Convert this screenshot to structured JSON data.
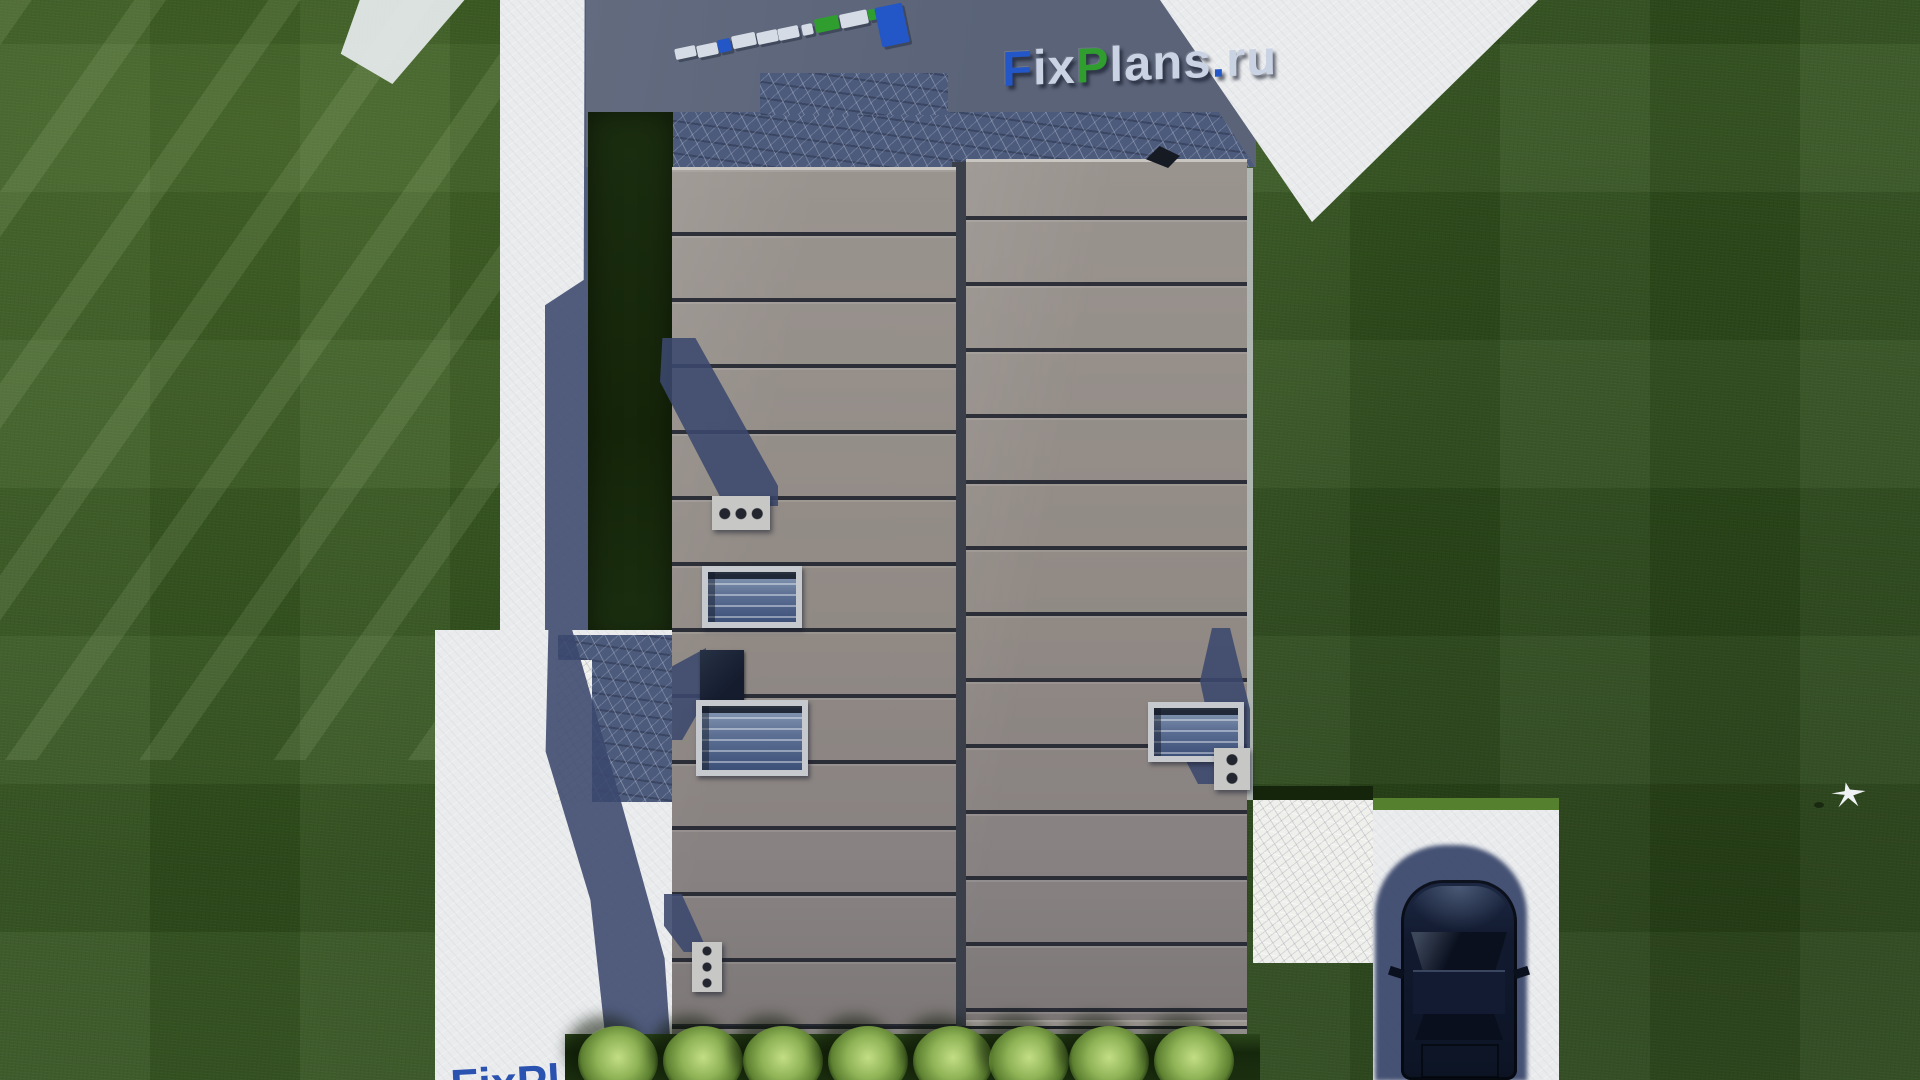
{
  "watermark": {
    "text": "FixPlans.ru",
    "letters": [
      {
        "ch": "F",
        "c": "blue"
      },
      {
        "ch": "i",
        "c": "light"
      },
      {
        "ch": "x",
        "c": "light"
      },
      {
        "ch": "P",
        "c": "green"
      },
      {
        "ch": "l",
        "c": "light"
      },
      {
        "ch": "a",
        "c": "light"
      },
      {
        "ch": "n",
        "c": "light"
      },
      {
        "ch": "s",
        "c": "light"
      },
      {
        "ch": ".",
        "c": "blue"
      },
      {
        "ch": "r",
        "c": "light"
      },
      {
        "ch": "u",
        "c": "light"
      }
    ]
  },
  "watermark_partial": {
    "text": "FixPl"
  },
  "ground_letters": {
    "description": "tops of 3D logo letters lying on the terrace, seen from above",
    "blocks": [
      {
        "x": 5,
        "y": 47,
        "w": 21,
        "h": 11,
        "c": "light"
      },
      {
        "x": 27,
        "y": 44,
        "w": 21,
        "h": 12,
        "c": "light"
      },
      {
        "x": 48,
        "y": 39,
        "w": 13,
        "h": 13,
        "c": "blue"
      },
      {
        "x": 62,
        "y": 34,
        "w": 24,
        "h": 13,
        "c": "light"
      },
      {
        "x": 87,
        "y": 31,
        "w": 21,
        "h": 12,
        "c": "light"
      },
      {
        "x": 108,
        "y": 27,
        "w": 21,
        "h": 12,
        "c": "light"
      },
      {
        "x": 132,
        "y": 24,
        "w": 11,
        "h": 11,
        "c": "light"
      },
      {
        "x": 145,
        "y": 17,
        "w": 24,
        "h": 14,
        "c": "green"
      },
      {
        "x": 170,
        "y": 12,
        "w": 28,
        "h": 14,
        "c": "light"
      },
      {
        "x": 198,
        "y": 9,
        "w": 10,
        "h": 11,
        "c": "green"
      },
      {
        "x": 208,
        "y": 5,
        "w": 28,
        "h": 40,
        "c": "blue"
      }
    ]
  },
  "bushes": {
    "count": 8,
    "centers_x": [
      618,
      703,
      783,
      868,
      953,
      1029,
      1109,
      1194
    ],
    "top_y": 1026
  },
  "palette": {
    "grass": "#30501c",
    "grass_dark_band": "#16280c",
    "hedge": "#16270d",
    "concrete_shadow": "#5a6378",
    "concrete_light": "#e9ebed",
    "stone_shadow": "#4c5a7c",
    "stone_light": "#efefec",
    "roof": "#918b88",
    "roof_seam": "#2e3340",
    "cast_shadow": "#3b486d",
    "car_body": "#131b2e",
    "bush": "#8fb356",
    "logo_blue": "#2356c7",
    "logo_green": "#2f9e2f",
    "logo_light": "#c9d3e4"
  }
}
